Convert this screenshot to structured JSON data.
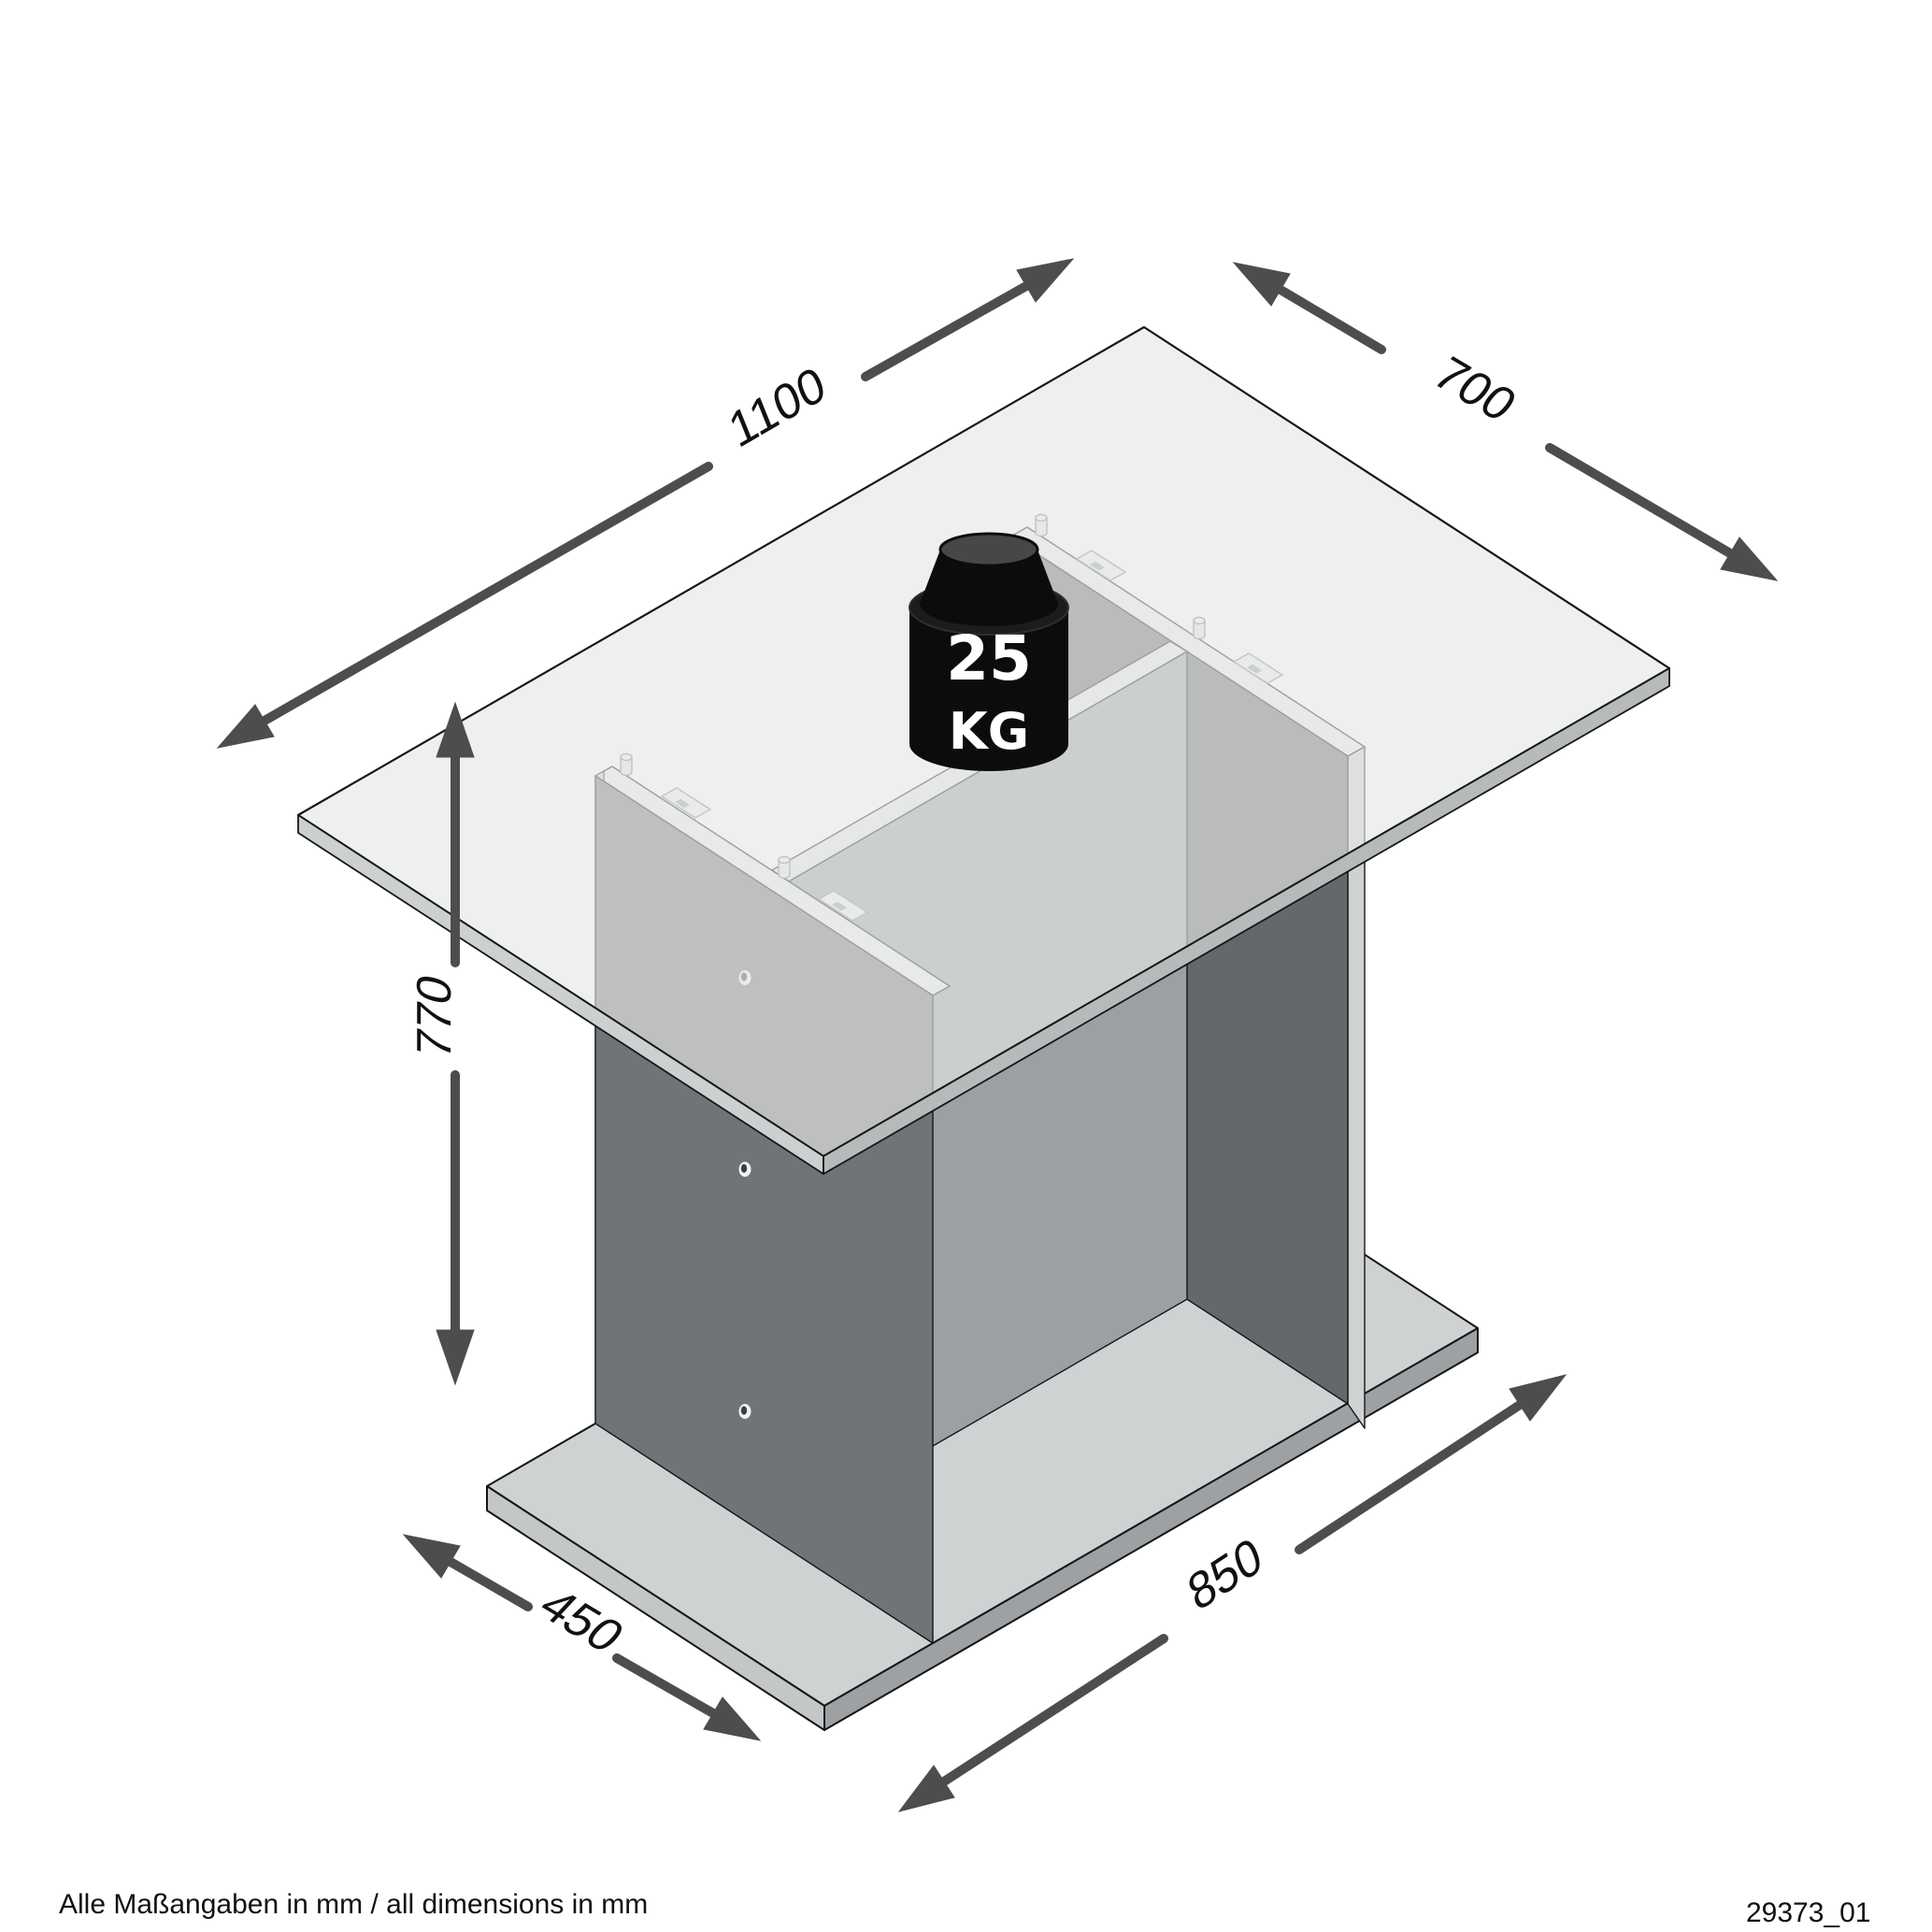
{
  "drawing": {
    "footer_note": "Alle Maßangaben in mm / all dimensions in mm",
    "drawing_number": "29373_01"
  },
  "dimension_labels": {
    "tabletop_length_mm": "1100",
    "tabletop_depth_mm": "700",
    "table_height_mm": "770",
    "base_depth_mm": "450",
    "base_length_mm": "850"
  },
  "load_badge": {
    "value": "25",
    "unit": "KG"
  },
  "palette": {
    "dimension_arrow": "#4d4d4d",
    "outline": "#161616",
    "tabletop_fill": "#ededed",
    "pedestal_dark": "#707477",
    "pedestal_mid": "#9aa0a3",
    "base_fill": "#ced2d3",
    "badge_bg": "#0c0c0c",
    "badge_text": "#ffffff"
  }
}
